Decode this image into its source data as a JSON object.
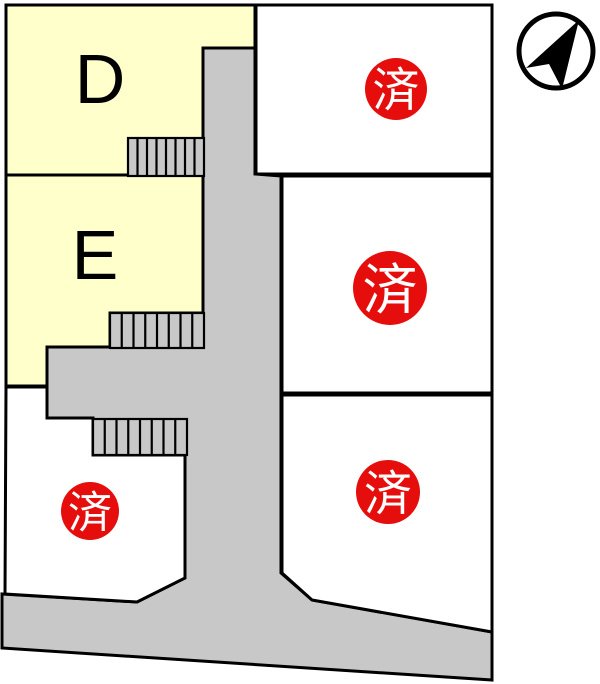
{
  "map_type": "lot-layout-plan",
  "colors": {
    "background": "#FFFFFF",
    "available_lot_fill": "#FFFFCC",
    "road_fill": "#C8C8C8",
    "outline": "#000000",
    "sold_badge_fill": "#E60D0D",
    "sold_badge_text": "#FFFFFF"
  },
  "lots": {
    "d": {
      "label": "D",
      "status": "available"
    },
    "e": {
      "label": "E",
      "status": "available"
    },
    "top_right": {
      "status_label": "済",
      "status": "sold"
    },
    "middle_right": {
      "status_label": "済",
      "status": "sold"
    },
    "bottom_right": {
      "status_label": "済",
      "status": "sold"
    },
    "bottom_left": {
      "status_label": "済",
      "status": "sold"
    }
  },
  "compass": {
    "icon": "north-arrow"
  },
  "stairs": [
    {
      "x": 128,
      "y": 138,
      "width": 76,
      "height": 38,
      "steps": 8
    },
    {
      "x": 110,
      "y": 313,
      "width": 94,
      "height": 35,
      "steps": 8
    },
    {
      "x": 93,
      "y": 419,
      "width": 94,
      "height": 36,
      "steps": 8
    }
  ]
}
